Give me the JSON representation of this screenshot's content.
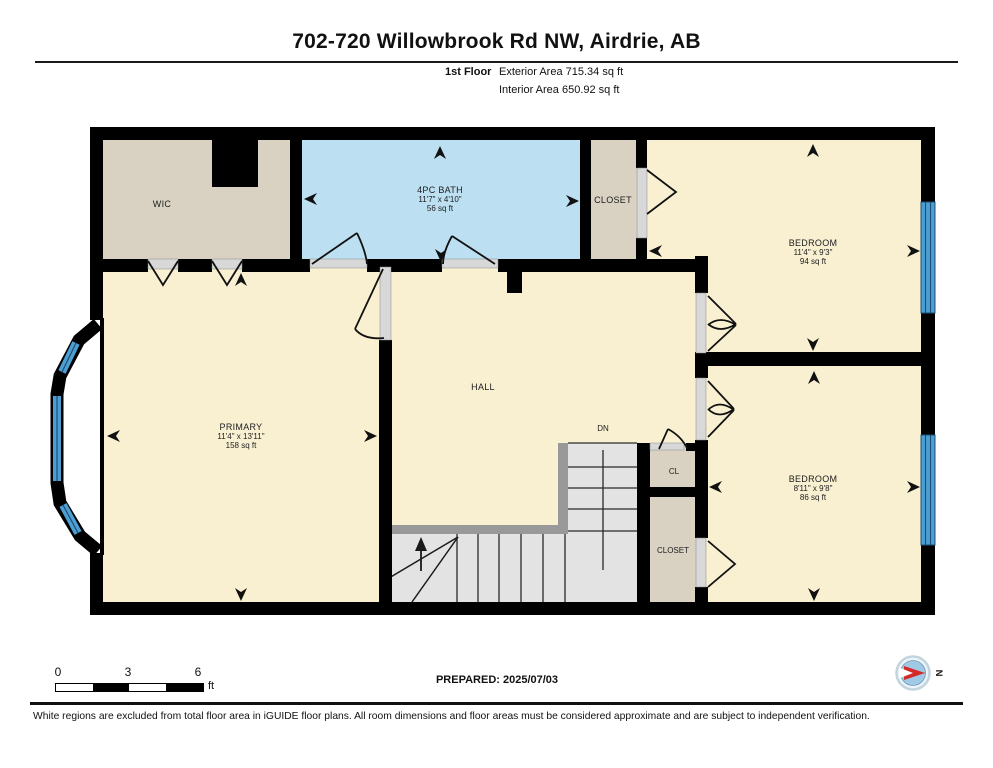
{
  "header": {
    "title": "702-720 Willowbrook Rd NW, Airdrie, AB",
    "floor_label": "1st Floor",
    "exterior_area": "Exterior Area 715.34 sq ft",
    "interior_area": "Interior Area 650.92 sq ft"
  },
  "rooms": {
    "wic": {
      "name": "WIC"
    },
    "bath": {
      "name": "4PC BATH",
      "dims": "11'7\" x 4'10\"",
      "area": "56 sq ft"
    },
    "closet_top": {
      "name": "CLOSET"
    },
    "bedroom_top": {
      "name": "BEDROOM",
      "dims": "11'4\" x 9'3\"",
      "area": "94 sq ft"
    },
    "primary": {
      "name": "PRIMARY",
      "dims": "11'4\" x 13'11\"",
      "area": "158 sq ft"
    },
    "hall": {
      "name": "HALL"
    },
    "stairs": {
      "down_label": "DN"
    },
    "cl": {
      "name": "CL"
    },
    "closet_bottom": {
      "name": "CLOSET"
    },
    "bedroom_bottom": {
      "name": "BEDROOM",
      "dims": "8'11\" x 9'8\"",
      "area": "86 sq ft"
    }
  },
  "scale_bar": {
    "tick0": "0",
    "tick3": "3",
    "tick6": "6",
    "unit": "ft"
  },
  "prepared": "PREPARED: 2025/07/03",
  "compass": {
    "label": "N"
  },
  "footer": "White regions are excluded from total floor area in iGUIDE floor plans. All room dimensions and floor areas must be considered approximate and are subject to independent verification.",
  "colors": {
    "room_cream": "#f9f0d2",
    "closet_beige": "#d9d2c3",
    "bath_blue": "#bcdff2",
    "window_blue": "#4d9fd3",
    "window_line": "#1c4f73",
    "stair_gray": "#e3e3e3",
    "rail_gray": "#999999",
    "wall_black": "#000000",
    "compass_red": "#d42a2a"
  }
}
